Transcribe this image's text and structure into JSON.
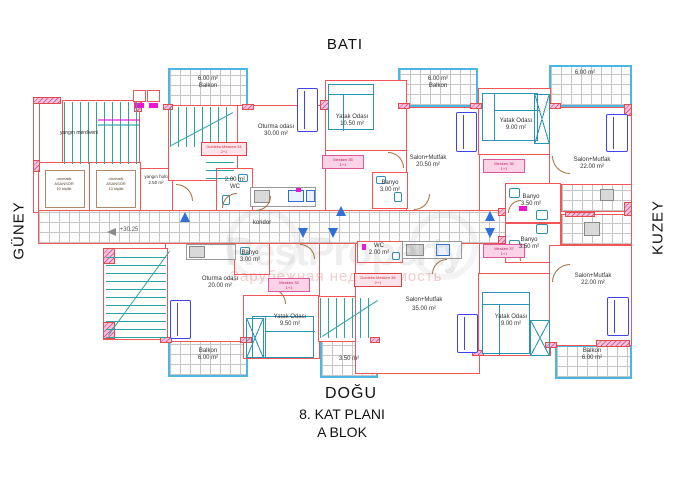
{
  "compass": {
    "top": "BATI",
    "bottom": "DOĞU",
    "left": "GÜNEY",
    "right": "KUZEY"
  },
  "title": {
    "floor": "8. KAT PLANI",
    "block": "A BLOK"
  },
  "watermark": {
    "brand": "RestProperty",
    "reg": "®",
    "subtitle": "Зарубежная недвижимость"
  },
  "core": {
    "fire_stairs": "yangın merdiveni",
    "fire_hall_name": "yangın holü",
    "fire_hall_area": "2.50 m²",
    "elevator_line1": "otomatik",
    "elevator_line2": "ASANSÖR",
    "elevator_line3": "10 kişilik",
    "corridor": "koridor",
    "level": "+30.25"
  },
  "rooms": [
    {
      "name": "Oturma odası",
      "area": "30.00 m²"
    },
    {
      "name": "Yatak Odası",
      "area": "10.50 m²"
    },
    {
      "name": "Salon+Mutfak",
      "area": "20.50 m²"
    },
    {
      "name": "Yatak Odası",
      "area": "9.00 m²"
    },
    {
      "name": "Salon+Mutfak",
      "area": "22.00 m²"
    },
    {
      "name": "WC",
      "area": "2.00 m²"
    },
    {
      "name": "Banyo",
      "area": "3.00 m²"
    },
    {
      "name": "Banyo",
      "area": "3.50 m²"
    },
    {
      "name": "Banyo",
      "area": "3.50 m²"
    },
    {
      "name": "Oturma odası",
      "area": "20.00 m²"
    },
    {
      "name": "Banyo",
      "area": "3.00 m²"
    },
    {
      "name": "Yatak Odası",
      "area": "9.50 m²"
    },
    {
      "name": "WC",
      "area": "2.00 m²"
    },
    {
      "name": "Salon+Mutfak",
      "area": "35.00 m²"
    },
    {
      "name": "Yatak Odası",
      "area": "9.00 m²"
    },
    {
      "name": "Salon+Mutfak",
      "area": "22.00 m²"
    }
  ],
  "balconies": [
    {
      "name": "Balkon",
      "area": "6.00 m²"
    },
    {
      "name": "Balkon",
      "area": "6.00 m²"
    },
    {
      "name": "",
      "area": "6.00 m²"
    },
    {
      "name": "Balkon",
      "area": "6.00 m²"
    },
    {
      "name": "",
      "area": "3.50 m²"
    },
    {
      "name": "Balkon",
      "area": "6.00 m²"
    }
  ],
  "unit_tags": [
    {
      "line1": "Dubleks Mesken 34",
      "line2": "2+1"
    },
    {
      "line1": "Mesken 35",
      "line2": "1+1"
    },
    {
      "line1": "Mesken 36",
      "line2": "1+1"
    },
    {
      "line1": "Mesken 37",
      "line2": "1+1"
    },
    {
      "line1": "Mesken 33",
      "line2": "1+1"
    },
    {
      "line1": "Dubleks Mesken 38",
      "line2": "2+1"
    }
  ]
}
